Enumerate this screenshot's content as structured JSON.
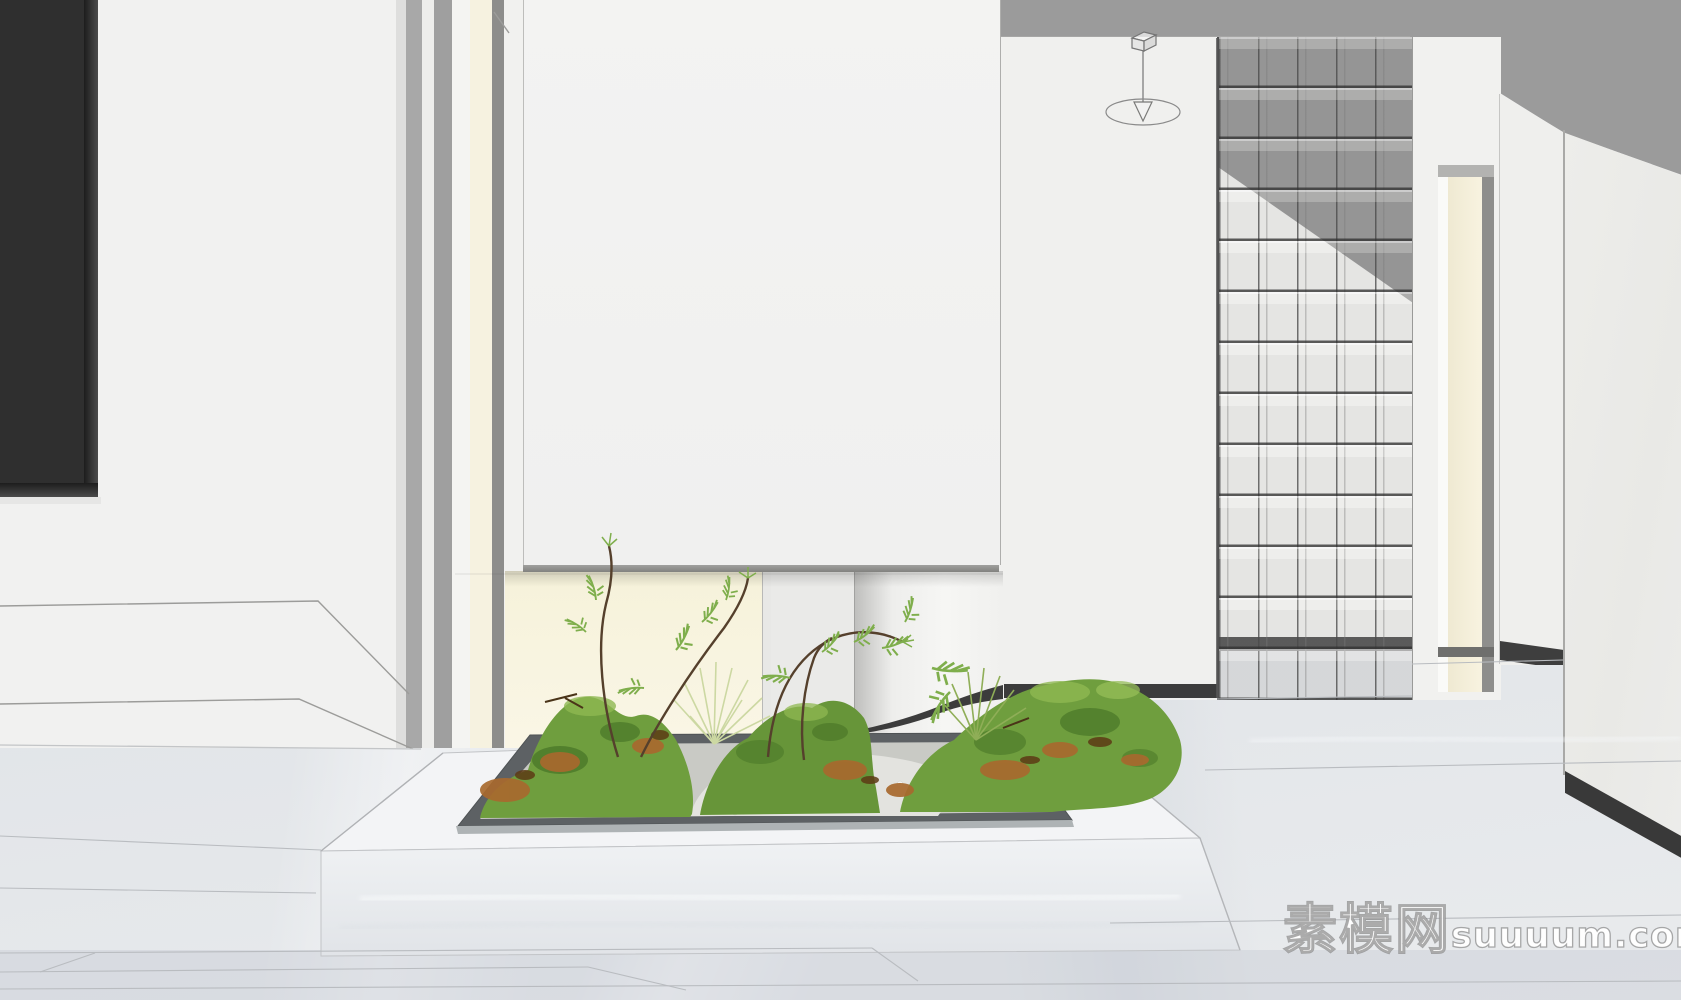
{
  "watermark": {
    "site_name_cjk": "素模网",
    "site_domain": "suuuum.com"
  },
  "scene": {
    "type": "3d-interior-render",
    "room": "minimalist hallway with sunken moss planter and glass-block partition",
    "objects": [
      "dark-tv-wall-panel",
      "paneled-white-wall",
      "doorway-recess-with-cream-door",
      "floating-white-partition",
      "backlit-cream-niche",
      "curved-wall-with-dark-base-trim",
      "sunken-moss-planter-with-metal-rim",
      "white-gravel-patch",
      "fern-saplings",
      "grass-tufts",
      "marble-plinth",
      "marble-tile-floor",
      "glass-block-partition",
      "far-cream-door",
      "pendant-lamp-wireframe",
      "gray-ceiling"
    ],
    "glass_block_wall": {
      "columns": 5,
      "rows": 13
    },
    "palette": {
      "ceiling": "#9b9b9b",
      "walls": "#f1f1f0",
      "accent_dark_trim": "#3a3a3a",
      "backlit_niche": "#f7f3df",
      "door_cream": "#f6f2e0",
      "moss_green": "#6f9e3e",
      "moss_dark": "#4f7a2b",
      "moss_light": "#8fb851",
      "gravel_white": "#e6e6e3",
      "leaf_litter_orange": "#a8692e",
      "marble_floor": "#e8eaec",
      "metal_rim": "#5d6164",
      "tv_panel": "#2f2f2f"
    }
  }
}
